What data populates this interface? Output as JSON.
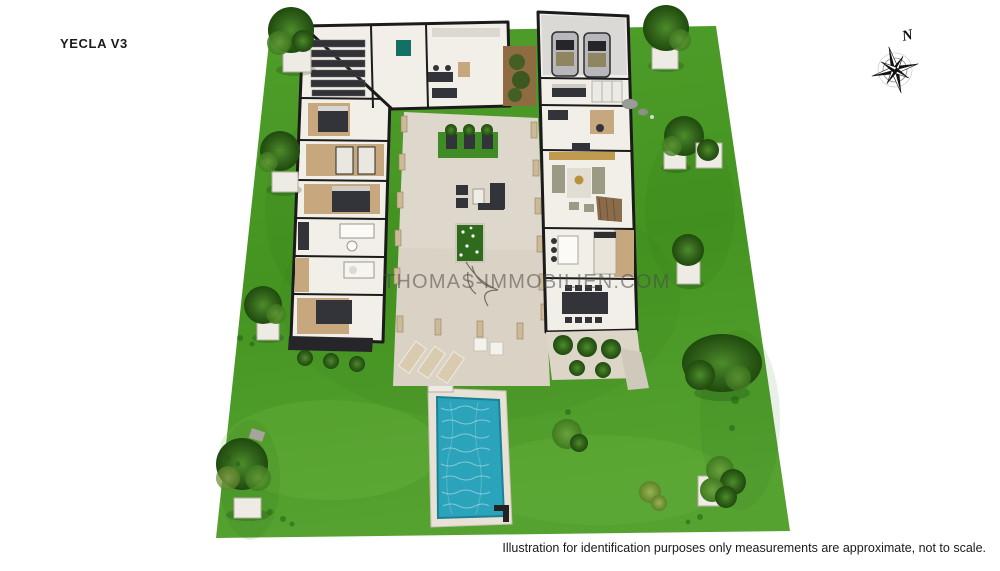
{
  "header": {
    "plan_title": "YECLA V3"
  },
  "compass": {
    "label": "N"
  },
  "watermark": {
    "text": "THOMAS-IMMOBILIEN.COM"
  },
  "footer": {
    "disclaimer": "Illustration for identification purposes only measurements are approximate, not to scale."
  },
  "colors": {
    "background": "#ffffff",
    "grass": "#479522",
    "grass_dark": "#2e7413",
    "grass_light": "#63ae3e",
    "pavement": "#d9d2c5",
    "deck": "#e7e1d6",
    "pool_water": "#2aa3bb",
    "wall": "#1b1b1b",
    "floor_white": "#f2efe8",
    "floor_wood": "#c7a87e",
    "furniture_dark": "#33333a",
    "planter_white": "#edebe3",
    "tree_dark": "#2c5a17",
    "text": "#1a1a1a",
    "watermark": "#4a4a4a"
  }
}
